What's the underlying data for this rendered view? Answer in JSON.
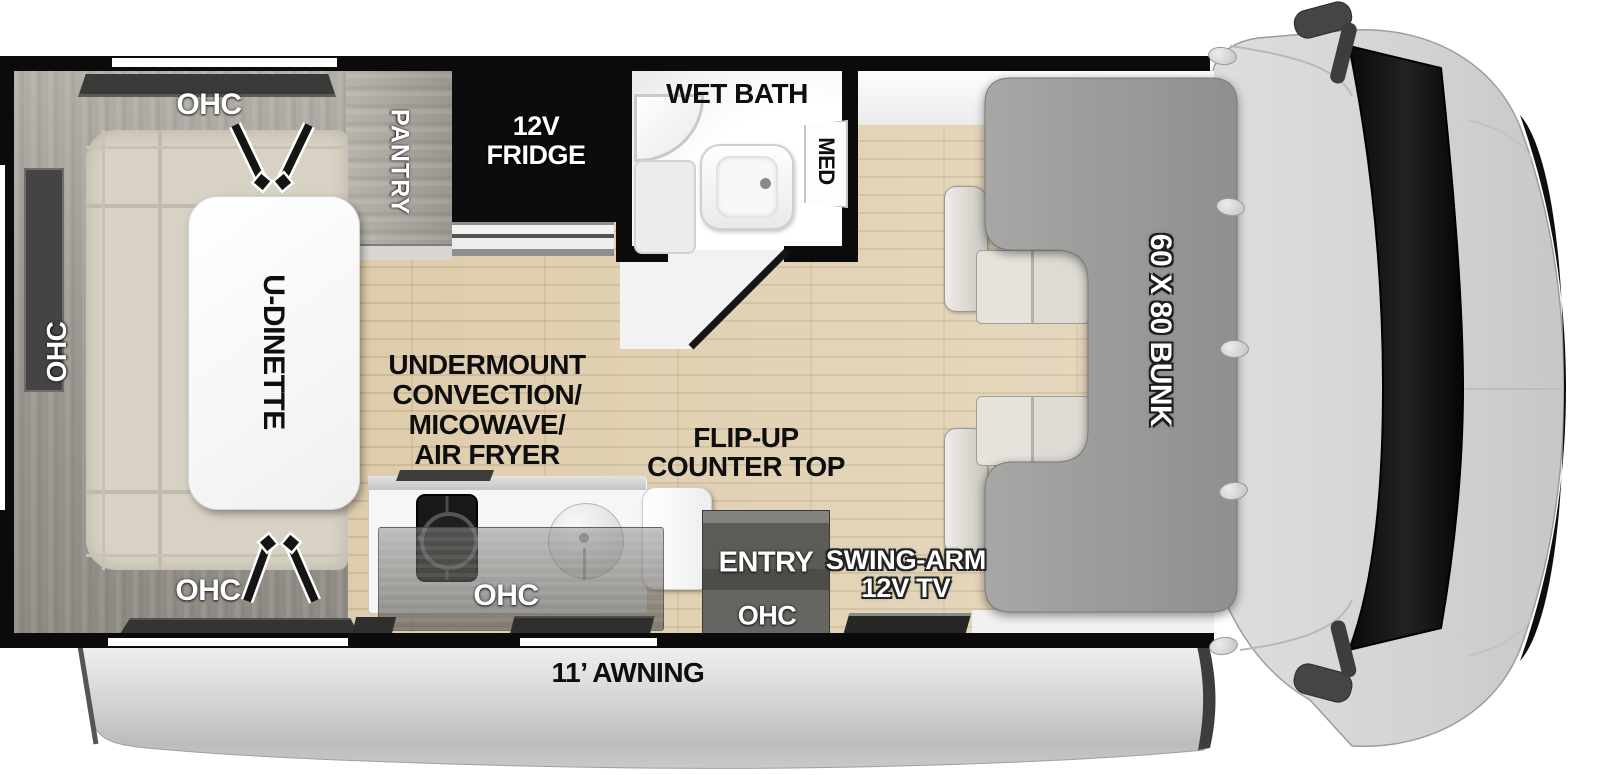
{
  "labels": {
    "ohc_dinette_top": "OHC",
    "ohc_dinette_left": "OHC",
    "ohc_dinette_bottom": "OHC",
    "u_dinette": "U-DINETTE",
    "pantry": "PANTRY",
    "fridge_line1": "12V",
    "fridge_line2": "FRIDGE",
    "wet_bath": "WET BATH",
    "med": "MED",
    "appliance_line1": "UNDERMOUNT",
    "appliance_line2": "CONVECTION/",
    "appliance_line3": "MICOWAVE/",
    "appliance_line4": "AIR FRYER",
    "flip_up_line1": "FLIP-UP",
    "flip_up_line2": "COUNTER TOP",
    "ohc_kitchen": "OHC",
    "entry": "ENTRY",
    "ohc_entry": "OHC",
    "tv_line1": "SWING-ARM",
    "tv_line2": "12V TV",
    "bunk": "60 X 80 BUNK",
    "awning": "11’ AWNING"
  },
  "colors": {
    "wall": "#0b0b0b",
    "floor_wood": "#dbc8a4",
    "bunk_gray": "#9c9c9a",
    "cab_gray": "#d8d8d8",
    "awning_gray": "#cdcdcd",
    "fridge_black": "#0c0c0c",
    "cushion_beige": "#d8d2c4",
    "cabinet_wood_gray": "#a19d96",
    "entry_door_gray": "#55554f",
    "bath_floor": "#f4f4f4"
  }
}
